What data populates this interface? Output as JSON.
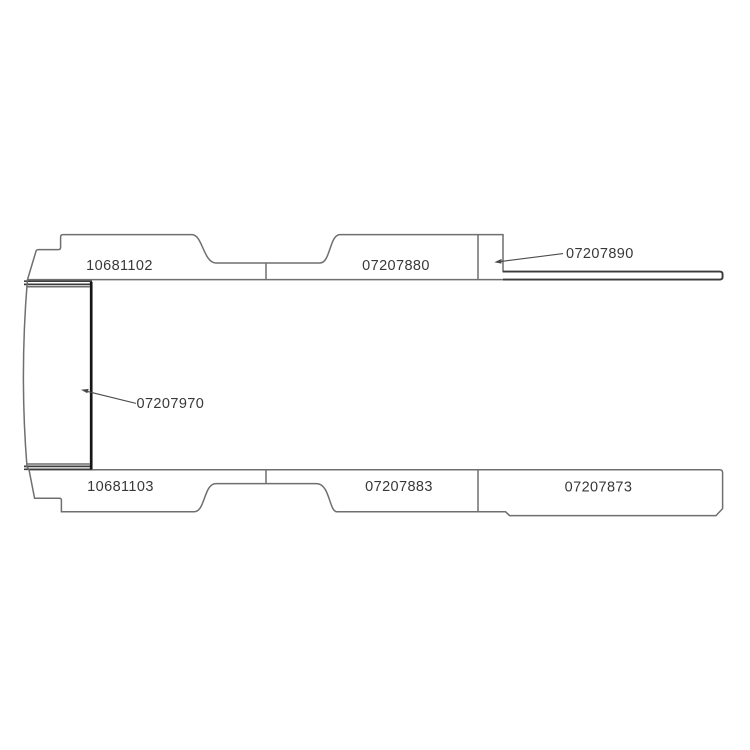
{
  "drawing": {
    "type": "technical-parts-diagram",
    "description": "Plan-view line drawing of van floor panels with part numbers and leader arrows",
    "colors": {
      "outline": "#6f6f6f",
      "strip": "#3c3c3c",
      "heavy": "#161616",
      "leader": "#4a4a4a",
      "text": "#383838",
      "background": "#ffffff"
    },
    "parts": [
      {
        "label": "10681102",
        "region": "top-left-panel"
      },
      {
        "label": "07207880",
        "region": "top-middle-panel"
      },
      {
        "label": "07207890",
        "region": "top-right-sill-strip",
        "has_leader_arrow": true
      },
      {
        "label": "07207970",
        "region": "front-left-panel",
        "has_leader_arrow": true
      },
      {
        "label": "10681103",
        "region": "bottom-left-panel"
      },
      {
        "label": "07207883",
        "region": "bottom-middle-panel"
      },
      {
        "label": "07207873",
        "region": "bottom-right-panel"
      }
    ]
  }
}
